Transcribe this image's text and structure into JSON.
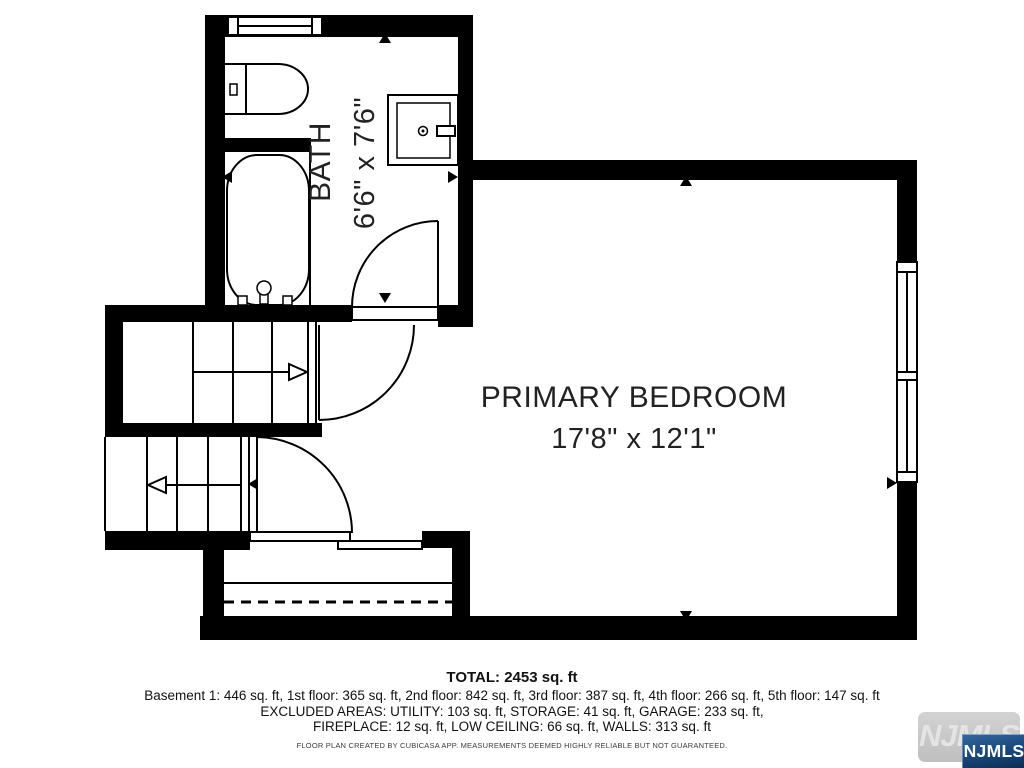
{
  "floor_plan": {
    "rooms": {
      "bath": {
        "name": "BATH",
        "dimensions": "6'6\" x 7'6\""
      },
      "primary_bedroom": {
        "name": "PRIMARY BEDROOM",
        "dimensions": "17'8\" x 12'1\""
      }
    },
    "colors": {
      "wall": "#000000",
      "floor": "#ffffff",
      "label_text": "#222222"
    }
  },
  "summary": {
    "total": "TOTAL: 2453 sq. ft",
    "floors": "Basement 1: 446 sq. ft, 1st floor: 365 sq. ft, 2nd floor: 842 sq. ft, 3rd floor: 387 sq. ft, 4th floor: 266 sq. ft, 5th floor: 147 sq. ft",
    "excluded_line1": "EXCLUDED AREAS: UTILITY: 103 sq. ft, STORAGE: 41 sq. ft, GARAGE: 233 sq. ft,",
    "excluded_line2": "FIREPLACE: 12 sq. ft, LOW CEILING: 66 sq. ft, WALLS: 313 sq. ft",
    "disclaimer": "FLOOR PLAN CREATED BY CUBICASA APP. MEASUREMENTS DEEMED HIGHLY RELIABLE BUT NOT GUARANTEED."
  },
  "branding": {
    "watermark_text": "NJMLS",
    "badge_text": "NJMLS",
    "badge_color": "#1b4a7f",
    "watermark_color": "#c6c6c6"
  }
}
